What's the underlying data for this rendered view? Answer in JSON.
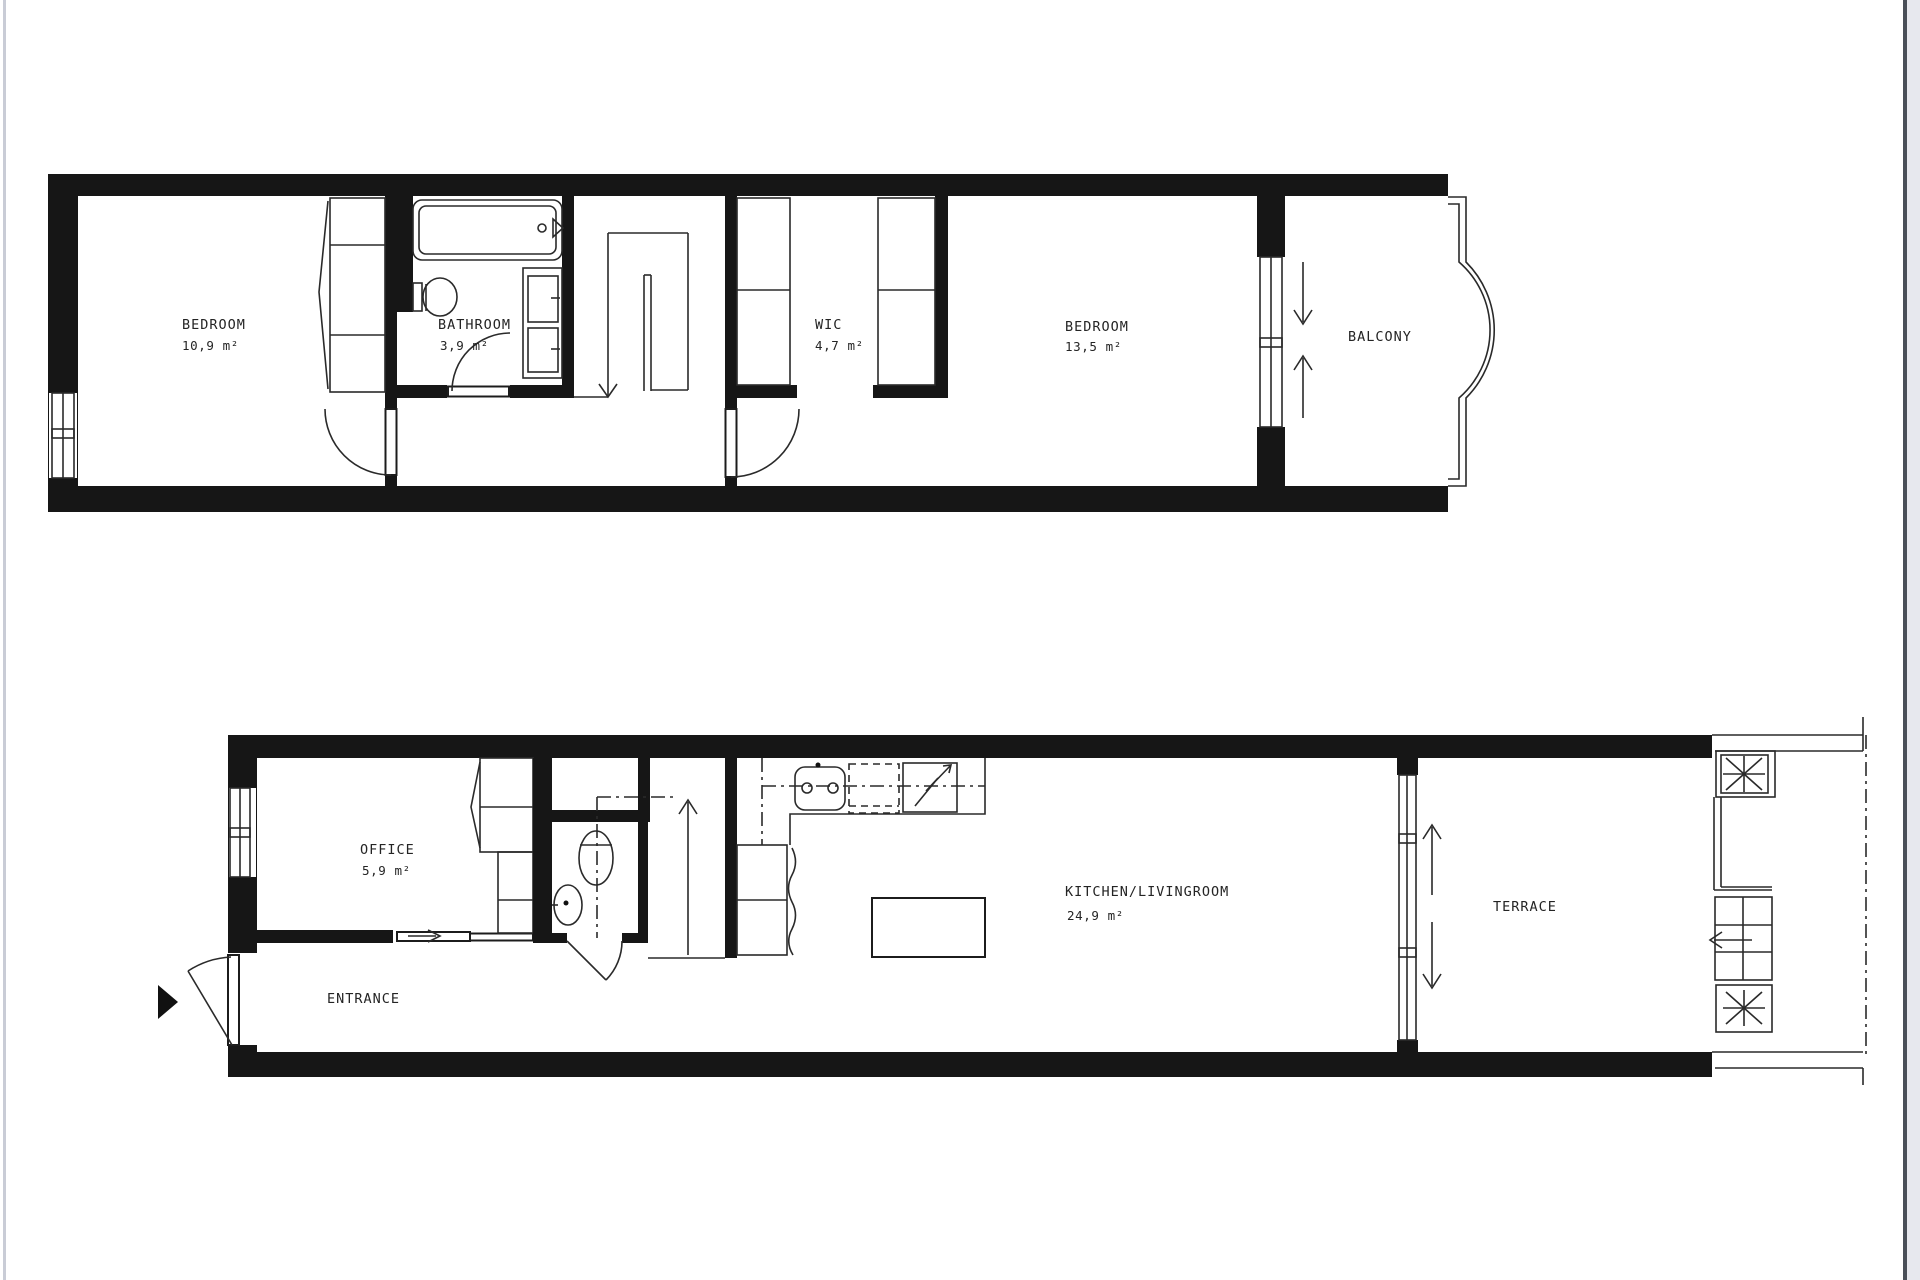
{
  "colors": {
    "ink": "#1a1a1a",
    "background": "#ffffff",
    "page_edge_dark": "#4a4f58",
    "page_edge_light": "#e7e8ee",
    "page_edge_left": "#c9ccd6"
  },
  "floors": {
    "upper": {
      "rooms": {
        "bedroom1": {
          "name": "BEDROOM",
          "area": "10,9 m²"
        },
        "bathroom": {
          "name": "BATHROOM",
          "area": "3,9 m²"
        },
        "wic": {
          "name": "WIC",
          "area": "4,7 m²"
        },
        "bedroom2": {
          "name": "BEDROOM",
          "area": "13,5 m²"
        },
        "balcony": {
          "name": "BALCONY"
        }
      }
    },
    "lower": {
      "rooms": {
        "office": {
          "name": "OFFICE",
          "area": "5,9 m²"
        },
        "entrance": {
          "name": "ENTRANCE"
        },
        "kitchen_livingroom": {
          "name": "KITCHEN/LIVINGROOM",
          "area": "24,9 m²"
        },
        "terrace": {
          "name": "TERRACE"
        }
      }
    }
  }
}
